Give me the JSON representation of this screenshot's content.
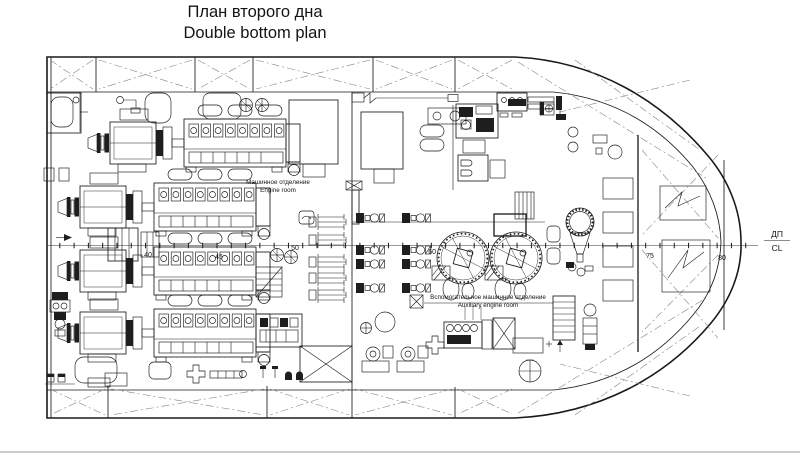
{
  "title": {
    "line1_ru": "План второго дна",
    "line2_en": "Double bottom plan"
  },
  "compartments": {
    "engine_room": {
      "ru": "Машинное отделение",
      "en": "Engine room"
    },
    "aux_engine_room": {
      "ru": "Вспомогательное машинное отделение",
      "en": "Auxiliary engine room"
    }
  },
  "centerline": {
    "ru": "ДП",
    "en": "CL"
  },
  "frame_numbers": [
    "40",
    "45",
    "50",
    "60",
    "75",
    "80"
  ],
  "colors": {
    "line": "#1a1a1a",
    "light_line": "#858585",
    "background": "#ffffff"
  }
}
